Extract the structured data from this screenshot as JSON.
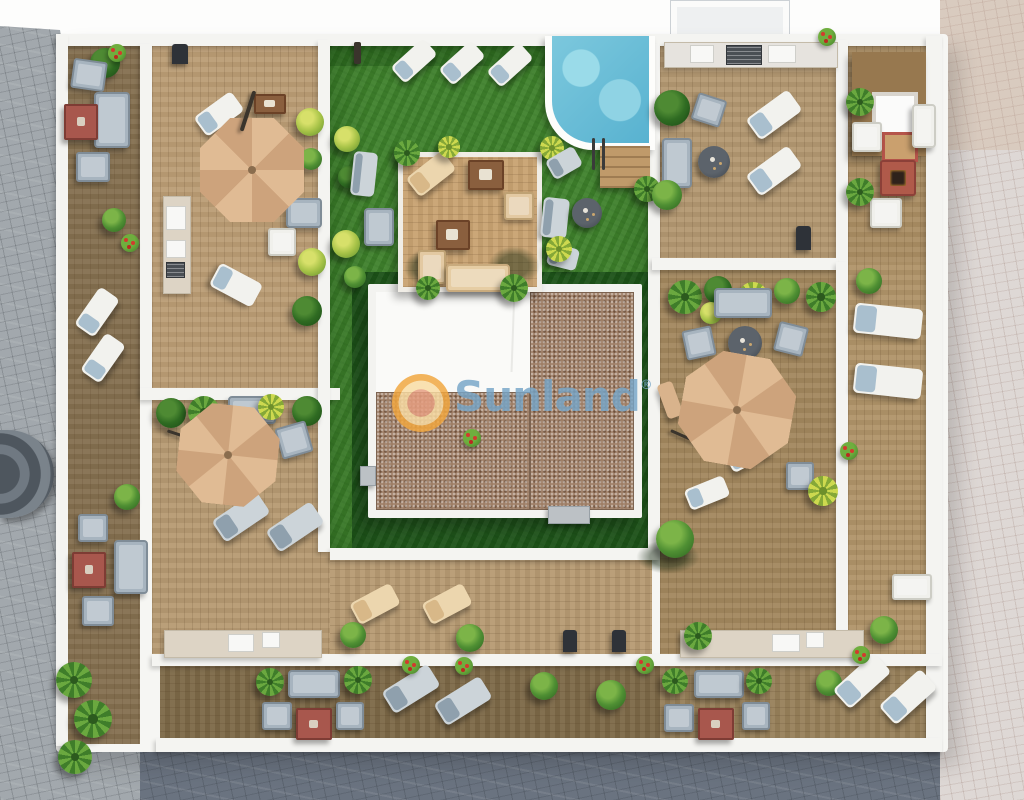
{
  "scene": {
    "type": "aerial-3d-architectural-render",
    "subject": "rooftop-terrace-community-solarium",
    "watermark": {
      "brand": "Sunland",
      "registered_mark": "®"
    },
    "palette": {
      "deck_wood_light": "#bb9d75",
      "deck_wood_dark": "#7c6847",
      "lawn_green": "#3f822c",
      "lawn_dark_green": "#235c1e",
      "pool_water": "#6cc0d8",
      "roof_gravel": "#9f7f67",
      "parasol_tan": "#d9b38c",
      "pavement_gray": "#a2a8ad",
      "pavement_dark": "#6a7380",
      "pavement_light": "#ded8d5",
      "furniture_white": "#f2f2ee",
      "furniture_gray_blue": "#a7b4bf",
      "table_red": "#a8574d",
      "wall_white": "#f4f4f1",
      "logo_orange": "#f1a63e",
      "logo_text_blue": "#76a5c8"
    },
    "objects": [
      "swimming-pool",
      "pool-steps",
      "wooden-platform",
      "parasol",
      "sun-lounger",
      "outdoor-sofa",
      "armchair",
      "fire-pit-table",
      "round-table",
      "coffee-table",
      "kitchenette-counter",
      "barbecue-grill",
      "planter-pot",
      "bush",
      "palm-plant",
      "air-conditioner-unit",
      "stairwell-roof",
      "lawn",
      "deck-terrace",
      "privacy-wall",
      "street-pavement",
      "entrance-canopy"
    ]
  }
}
